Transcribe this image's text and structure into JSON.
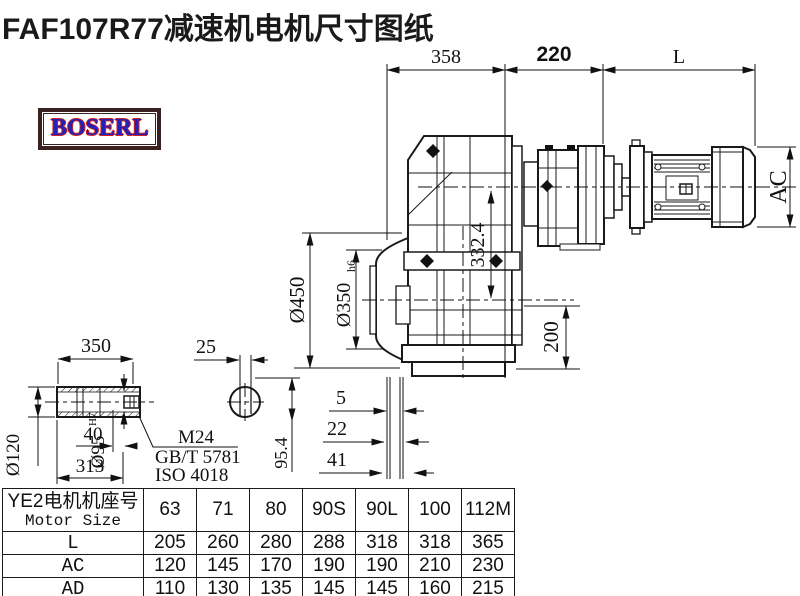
{
  "title": "FAF107R77减速机电机尺寸图纸",
  "logo": {
    "text": "BOSERL"
  },
  "drawing": {
    "dims": {
      "top_left": "358",
      "top_mid": "220",
      "top_right": "L",
      "motor_height": "AC",
      "center_height": "332.4",
      "foot_height": "200",
      "flange_od": "Ø450",
      "spigot": "Ø350",
      "spigot_tol": "h6",
      "offset_a": "5",
      "offset_b": "22",
      "offset_c": "41",
      "shaft_drop": "95.4",
      "shaft_len": "350",
      "key_width": "25",
      "hub_od": "Ø120",
      "bore": "Ø95",
      "bore_tol": "H7",
      "thread_len": "40",
      "bore_depth": "313",
      "screw": "M24",
      "screw_std1": "GB/T 5781",
      "screw_std2": "ISO 4018"
    }
  },
  "table": {
    "header": {
      "label_cn": "YE2电机机座号",
      "label_en": "Motor Size",
      "sizes": [
        "63",
        "71",
        "80",
        "90S",
        "90L",
        "100",
        "112M"
      ]
    },
    "rows": [
      {
        "label": "L",
        "values": [
          "205",
          "260",
          "280",
          "288",
          "318",
          "318",
          "365"
        ]
      },
      {
        "label": "AC",
        "values": [
          "120",
          "145",
          "170",
          "190",
          "190",
          "210",
          "230"
        ]
      },
      {
        "label": "AD",
        "values": [
          "110",
          "130",
          "135",
          "145",
          "145",
          "160",
          "215"
        ]
      }
    ]
  }
}
